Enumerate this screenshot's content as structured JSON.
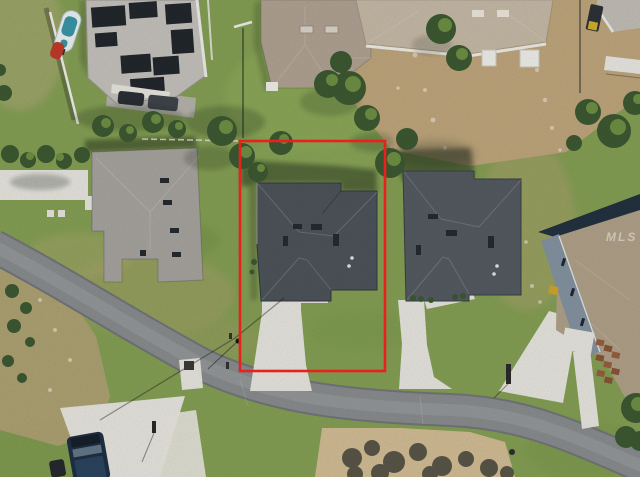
{
  "watermark": {
    "text": "MLS"
  },
  "annotation": {
    "label": "subject-property-boundary",
    "shape": "rectangle",
    "color": "#e8211c",
    "stroke_px": 3
  },
  "scene": {
    "type": "aerial-photo",
    "features": [
      "curved gray residential street sweeping across the lower half",
      "red rectangle outlining the subject lot with a dark gray hip-roof house and straight concrete driveway",
      "matching gray hip-roof neighbor house with driveway to the right",
      "house with rooftop solar panel arrays at top left",
      "boat and red personal watercraft parked along a white fence",
      "dark blue pickup truck on a driveway at bottom left",
      "bare dirt backyard behind upper-right homes",
      "sand patch with bushy tree shadows below the street",
      "scattered green trees and mottled dry grass"
    ]
  },
  "colors": {
    "grass": "#86a155",
    "grassdry": "#aca36c",
    "dirt": "#c1a87e",
    "sand": "#d4bf96",
    "brush": "#b3a477",
    "road": "#8b8e90",
    "roadedge": "#74777a",
    "concrete": "#eae8e1",
    "roofdark": "#4e555b",
    "roofmid": "#555c62",
    "roofgray": "#a9a6a1",
    "rooftan": "#c8bba8",
    "roofcenter": "#b2a494",
    "rooffar": "#b2a38a",
    "wallblue": "#8695a3",
    "solar": "#23282d",
    "panelhouse": "#c7c4bf",
    "tree": "#3d5a32",
    "treelight": "#6f9145",
    "shadowc": "rgba(24,34,20,0.45)",
    "boundary": "#e8211c",
    "white": "#f2f1ec",
    "porch": "#b08048",
    "paver": "#9a5f3e",
    "truck": "#203044",
    "boat": "#eef4f4",
    "teal": "#3a97a8",
    "jetski": "#c23b2a"
  }
}
